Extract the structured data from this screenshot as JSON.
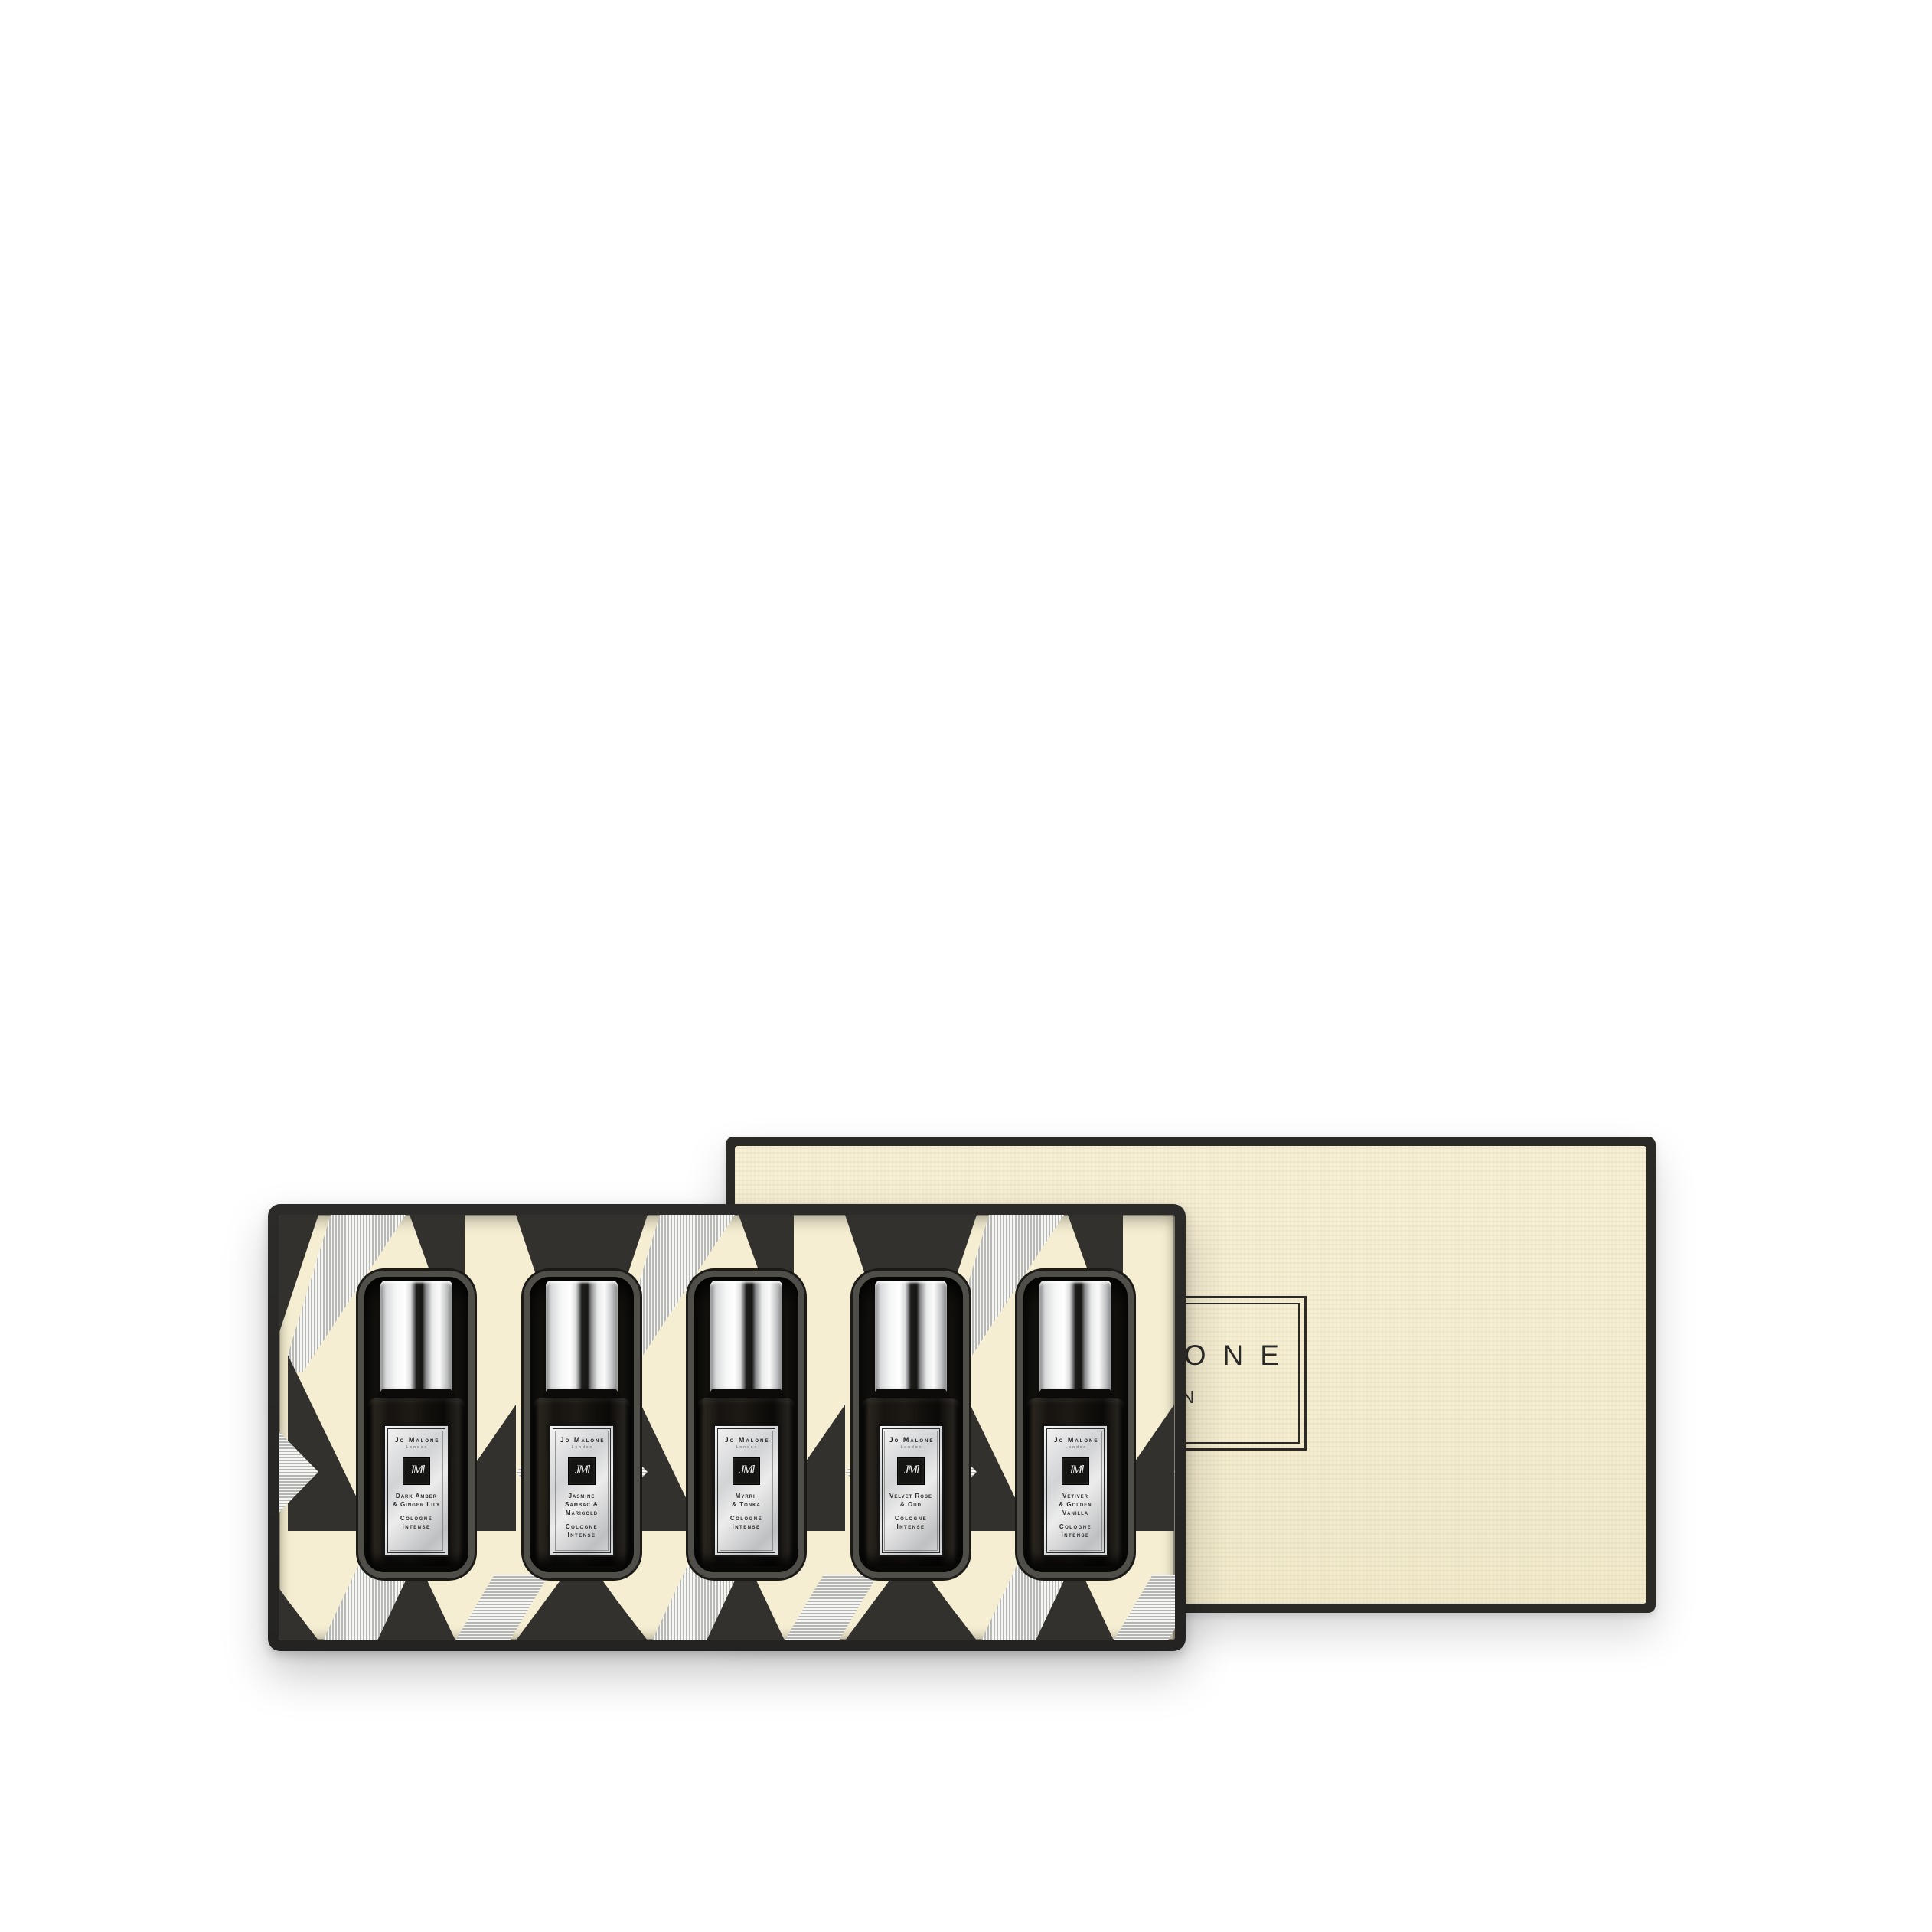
{
  "product": {
    "lid": {
      "brand": "JO MALONE",
      "city": "LONDON"
    },
    "label_brand": "Jo Malone",
    "label_city": "London",
    "monogram": "JMl",
    "type_lines": [
      "Cologne",
      "Intense"
    ],
    "fragrances": [
      {
        "name_lines": [
          "Dark Amber",
          "& Ginger Lily"
        ]
      },
      {
        "name_lines": [
          "Jasmine",
          "Sambac &",
          "Marigold"
        ]
      },
      {
        "name_lines": [
          "Myrrh",
          "& Tonka"
        ]
      },
      {
        "name_lines": [
          "Velvet Rose",
          "& Oud"
        ]
      },
      {
        "name_lines": [
          "Vetiver",
          "& Golden",
          "Vanilla"
        ]
      }
    ]
  },
  "colors": {
    "background": "#FFFFFF",
    "cream": "#F5EED2",
    "charcoal": "#33312D",
    "box_edge": "#2B2A27",
    "silver": "#D9DADB",
    "label_text": "#2B2A28"
  }
}
